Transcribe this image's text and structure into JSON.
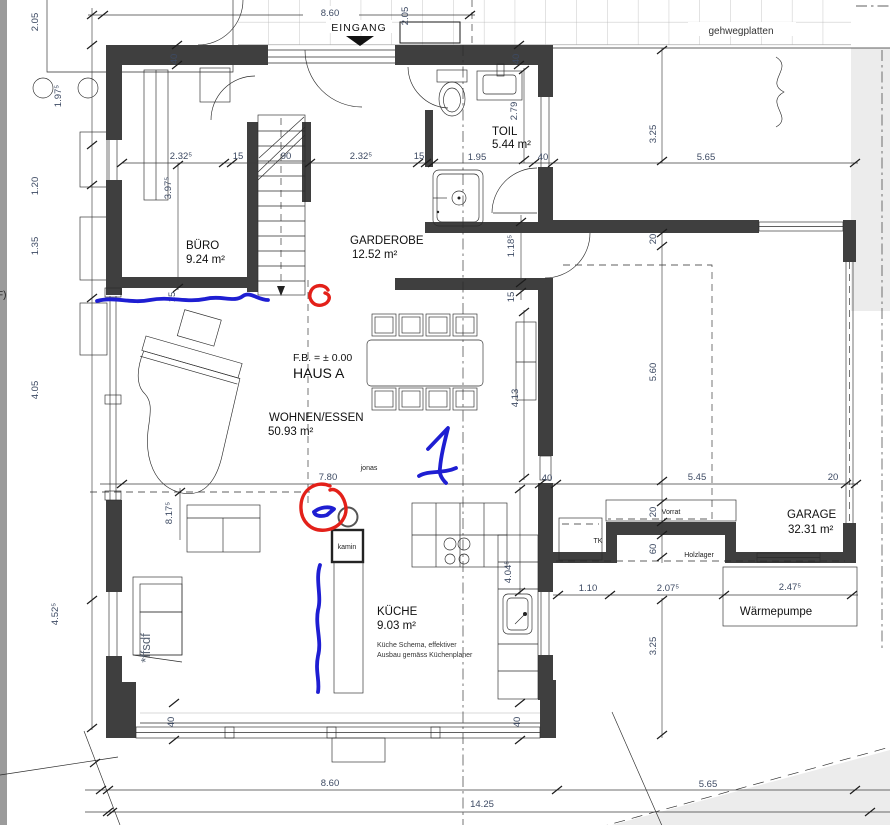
{
  "t": {
    "eingang": "EINGANG",
    "gehweg": "gehwegplatten",
    "fb": "F.B. = ± 0.00",
    "haus": "HAUS A",
    "jonas": "jonas",
    "ffsdf": "*ffsdf",
    "f_edge": "F)",
    "kamin": "kamin",
    "vorrat": "Vorrat",
    "holzlager": "Holzlager",
    "tk": "TK",
    "wp": "Wärmepumpe",
    "note1": "Küche Schema, effektiver",
    "note2": "Ausbau gemäss Küchenplaner"
  },
  "rooms": {
    "buero": {
      "name": "BÜRO",
      "area": "9.24 m²"
    },
    "toil": {
      "name": "TOIL",
      "area": "5.44 m²"
    },
    "garderobe": {
      "name": "GARDEROBE",
      "area": "12.52 m²"
    },
    "wohnen": {
      "name": "WOHNEN/ESSEN",
      "area": "50.93 m²"
    },
    "kueche": {
      "name": "KÜCHE",
      "area": "9.03 m²"
    },
    "garage": {
      "name": "GARAGE",
      "area": "32.31 m²"
    }
  },
  "dims": {
    "top860": "8.60",
    "e205": "2.05",
    "l205": "2.05",
    "l197": "1.97⁵",
    "l120": "1.20",
    "l135": "1.35",
    "l405": "4.05",
    "l452": "4.52⁵",
    "b232a": "2.32⁵",
    "b397": "3.97⁵",
    "b15a": "15",
    "b90": "90",
    "b232b": "2.32⁵",
    "b15b": "15",
    "t195": "1.95",
    "t40": "40",
    "t279": "2.79",
    "r325": "3.25",
    "r565": "5.65",
    "w40tl": "40",
    "w40tr": "40",
    "g118": "1.18⁵",
    "g15r": "15",
    "g15l": "15",
    "m780": "7.80",
    "m413": "4.13",
    "m40": "40",
    "m404": "4.04⁵",
    "m817": "8.17⁵",
    "ga545": "5.45",
    "ga20": "20",
    "ga20t": "20",
    "ga560": "5.60",
    "ga20v": "20",
    "ga60": "60",
    "wb110": "1.10",
    "wb207": "2.07⁵",
    "wb247": "2.47⁵",
    "bt860": "8.60",
    "bt565": "5.65",
    "bt1425": "14.25",
    "bt325": "3.25",
    "w40bl": "40",
    "w40br": "40"
  },
  "colors": {
    "wall": "#3f3f3f",
    "annotation_blue": "#1e1ed2",
    "annotation_red": "#e32019"
  }
}
